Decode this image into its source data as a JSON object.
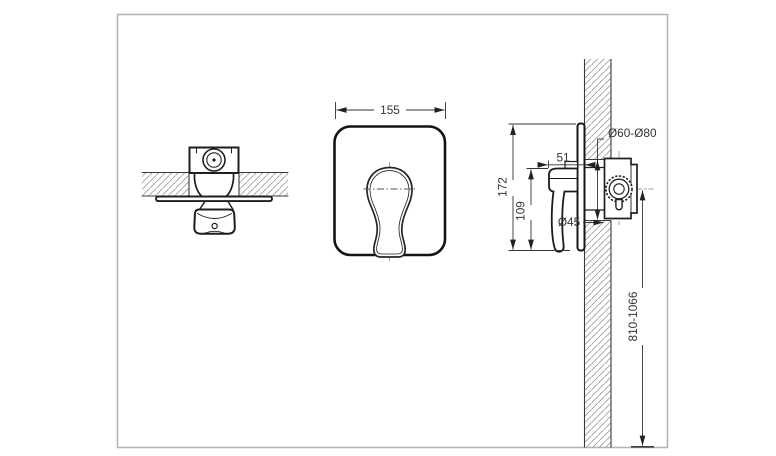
{
  "drawing": {
    "title_hint": "concealed-shower-mixer-installation-diagram",
    "labels": {
      "front_width": "155",
      "side_height": "172",
      "side_handle_height": "109",
      "side_depth_from_wall": "51",
      "cartridge_diameter": "Ø45",
      "wall_hole_diameter": "Ø60-Ø80",
      "installation_height": "810-1066"
    },
    "colors": {
      "line": "#222222",
      "hatch": "#999999",
      "frame": "#b3b3b3",
      "background": "#ffffff"
    }
  }
}
